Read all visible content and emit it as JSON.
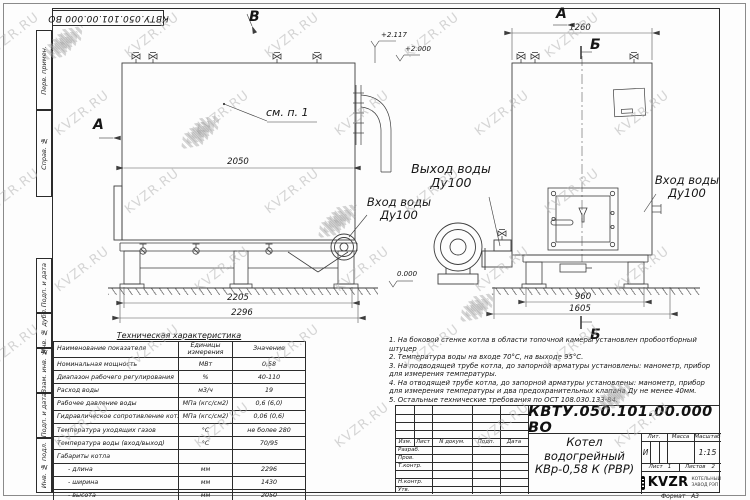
{
  "watermark": {
    "text": "KVZR.RU"
  },
  "frame": {
    "doc_number_top": "КВТУ.050.101.00.000  ВО",
    "margin_stamps": [
      "Перв. примен.",
      "Справ. №",
      "Подп. и дата",
      "Инв. № дубл.",
      "Взам. инв. №",
      "Подп. и дата",
      "Инв. № подл."
    ]
  },
  "views": {
    "side": {
      "marker_top": "В",
      "marker_left": "А",
      "see_note": "см. п. 1",
      "elev1": "+2.117",
      "elev2": "+2.000",
      "elev_zero": "0.000",
      "dim_inner": "2050",
      "dim_base": "2205",
      "dim_overall": "2296",
      "label_outlet": "Выход воды",
      "label_outlet_dn": "Ду100",
      "label_inlet": "Вход воды",
      "label_inlet_dn": "Ду100"
    },
    "front": {
      "marker_top": "А",
      "marker_section": "Б",
      "dim_top": "1260",
      "dim_base": "960",
      "dim_overall": "1605",
      "label_inlet": "Вход воды",
      "label_inlet_dn": "Ду100"
    }
  },
  "tech_table": {
    "title": "Техническая характеристика",
    "col_name": "Наименование показателя",
    "col_units": "Единицы измерения",
    "col_value": "Значение",
    "rows": [
      [
        "Номинальная мощность",
        "МВт",
        "0,58"
      ],
      [
        "Диапазон рабочего регулирования",
        "%",
        "40-110"
      ],
      [
        "Расход воды",
        "м3/ч",
        "19"
      ],
      [
        "Рабочее давление воды",
        "МПа (кгс/см2)",
        "0,6 (6,0)"
      ],
      [
        "Гидравлическое сопротивление котла",
        "МПа (кгс/см2)",
        "0,06 (0,6)"
      ],
      [
        "Температура уходящих газов",
        "°С",
        "не более 280"
      ],
      [
        "Температура воды (вход/выход)",
        "°С",
        "70/95"
      ],
      [
        "Габариты котла",
        "",
        ""
      ],
      [
        "- длина",
        "мм",
        "2296"
      ],
      [
        "- ширина",
        "мм",
        "1430"
      ],
      [
        "- высота",
        "мм",
        "2050"
      ]
    ]
  },
  "notes": [
    "1.  На боковой стенке котла в области топочной камеры установлен пробоотборный штуцер",
    "2.  Температура воды на входе 70°С, на выходе 95°С.",
    "3.  На подводящей трубе котла, до запорной арматуры установлены: манометр, прибор для измерения температуры.",
    "4.  На отводящей трубе котла, до запорной арматуры установлены: манометр, прибор для измерения температуры и два предохранительных клапана Ду не менее 40мм.",
    "5.  Остальные технические требования по ОСТ 108.030.133-84."
  ],
  "title_block": {
    "doc_number": "КВТУ.050.101.00.000  ВО",
    "title_line1": "Котел водогрейный",
    "title_line2": "КВр-0,58  К  (РВР)",
    "header_cells": [
      "Изм.",
      "Лист",
      "N докум.",
      "Подп.",
      "Дата"
    ],
    "row_labels": [
      "Разраб.",
      "Пров.",
      "Т.контр.",
      "",
      "Н.контр.",
      "Утв."
    ],
    "lit_label": "Лит.",
    "lit_value": "И",
    "mass_label": "Масса",
    "scale_label": "Масштаб",
    "scale_value": "1:15",
    "sheet_label": "Лист",
    "sheet_value": "1",
    "sheets_label": "Листов",
    "sheets_value": "2",
    "logo_text": "KVZR",
    "logo_sub1": "КОТЕЛЬНЫЙ",
    "logo_sub2": "ЗАВОД РЭП",
    "format_label": "Формат",
    "format_value": "А3"
  }
}
